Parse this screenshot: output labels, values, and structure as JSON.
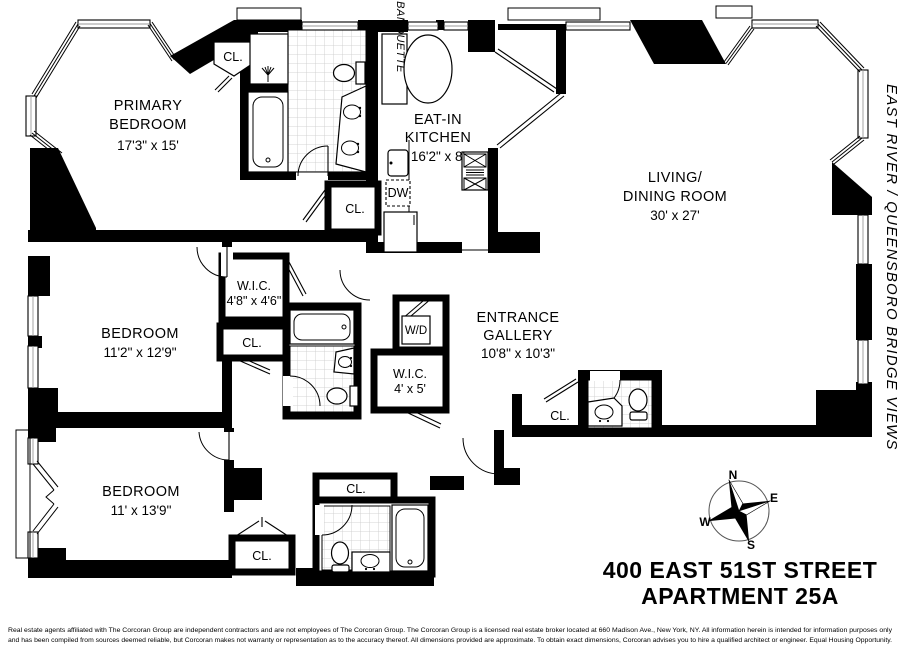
{
  "labels": {
    "closet": "CL.",
    "washer_dryer": "W/D",
    "dishwasher": "DW",
    "banquette": "BANQUETTE"
  },
  "rooms": {
    "primary_bedroom": {
      "line1": "PRIMARY",
      "line2": "BEDROOM",
      "dims": "17'3\" x 15'"
    },
    "eat_in_kitchen": {
      "line1": "EAT-IN",
      "line2": "KITCHEN",
      "dims": "16'2\" x 8'"
    },
    "living_dining_room": {
      "line1": "LIVING/",
      "line2": "DINING ROOM",
      "dims": "30' x 27'"
    },
    "bedroom_middle": {
      "line1": "BEDROOM",
      "dims": "11'2\" x 12'9\""
    },
    "bedroom_lower": {
      "line1": "BEDROOM",
      "dims": "11' x 13'9\""
    },
    "walk_in_closet_1": {
      "line1": "W.I.C.",
      "dims": "4'8\" x 4'6\""
    },
    "walk_in_closet_2": {
      "line1": "W.I.C.",
      "dims": "4' x 5'"
    },
    "entrance_gallery": {
      "line1": "ENTRANCE",
      "line2": "GALLERY",
      "dims": "10'8\" x 10'3\""
    }
  },
  "annotations": {
    "view": "EAST RIVER / QUEENSBORO BRIDGE VIEWS",
    "address_line1": "400 EAST 51ST STREET",
    "address_line2": "APARTMENT 25A"
  },
  "compass": {
    "north": "N",
    "east": "E",
    "south": "S",
    "west": "W"
  },
  "disclaimer": {
    "line1": "Real estate agents affiliated with The Corcoran Group are independent contractors and are not employees of The Corcoran Group. The Corcoran Group is a licensed real estate broker located at 660 Madison Ave., New York, NY. All information herein is intended for information purposes only",
    "line2": "and has been compiled from sources deemed reliable, but Corcoran makes not warranty or representation as to the accuracy thereof. All dimensions provided are approximate. To obtain exact dimensions, Corcoran advises you to hire a qualified architect or engineer. Equal Housing Opportunity."
  },
  "colors": {
    "walls": "#000000",
    "background": "#ffffff",
    "tile_line": "#c9c9c9"
  }
}
